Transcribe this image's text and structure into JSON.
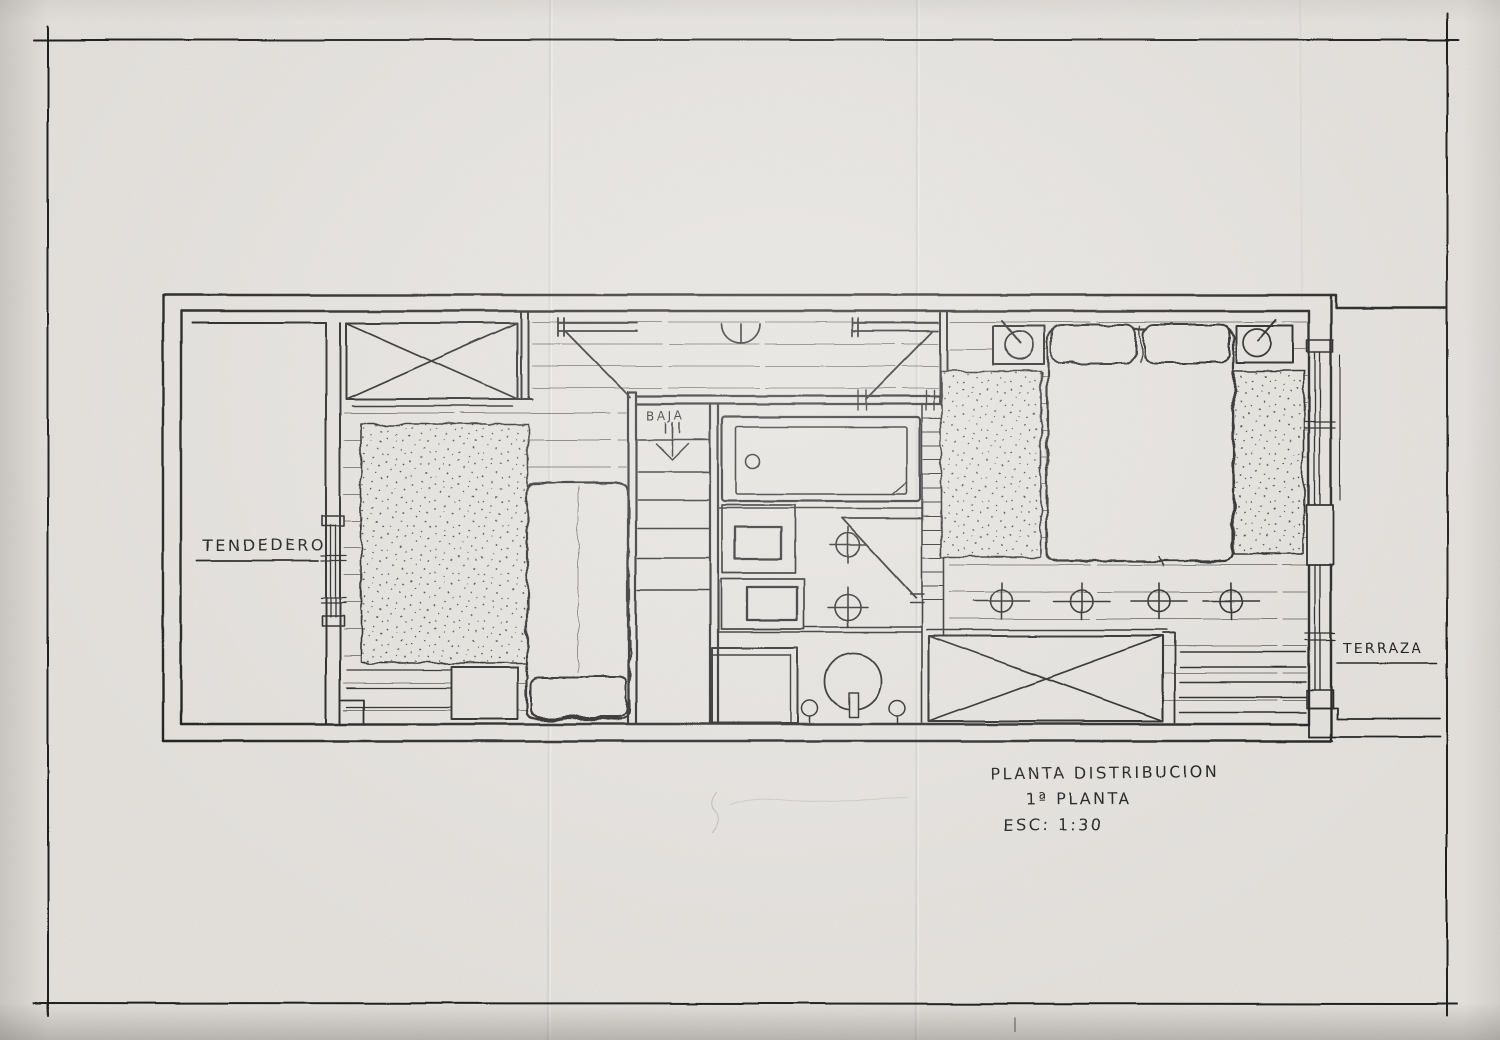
{
  "paper": {
    "background": "#edeae6",
    "ink": "#1f1f1f"
  },
  "plan": {
    "room_labels": {
      "tendedero": "TENDEDERO",
      "terraza": "TERRAZA"
    },
    "stairs": {
      "direction_label": "BAJA"
    },
    "title_block": {
      "line1": "PLANTA DISTRIBUCION",
      "line2": "1ª PLANTA",
      "line3": "ESC: 1:30"
    }
  }
}
